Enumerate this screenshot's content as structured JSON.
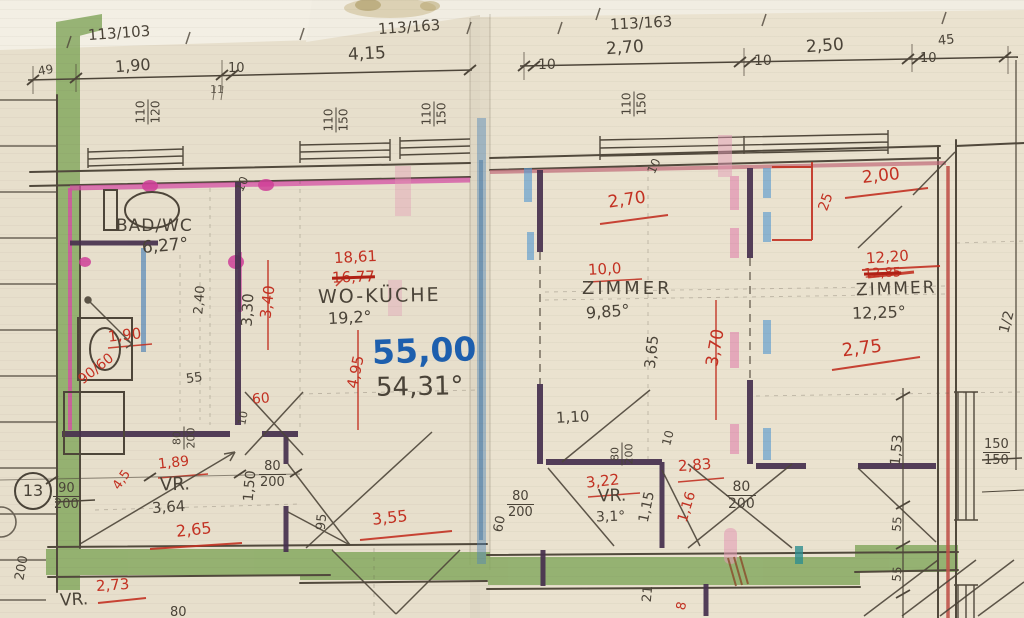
{
  "doc": {
    "type": "hand-drawn apartment floor plan"
  },
  "colors": {
    "paper": "#e7dfcc",
    "pencil": "#4a4338",
    "red_ink": "#c33122",
    "blue_ink": "#1d5fae",
    "green_marker": "#83a75d",
    "magenta_marker": "#d44fa4",
    "purple_wall": "#46304e",
    "red_wall": "#c0544a",
    "blue_marker": "#4f86b8",
    "pink_marker": "#e39ab5"
  },
  "header": {
    "parcel_left": "113/103",
    "parcel_mid": "113/163",
    "parcel_right": "113/163",
    "d_49": "49",
    "d_190": "1,90",
    "d_10a": "10",
    "d_415": "4,15",
    "d_10b": "10",
    "d_270": "2,70",
    "d_10c": "10",
    "d_250": "2,50",
    "d_10d": "10",
    "d_45": "45",
    "tick_11": "11"
  },
  "windows": {
    "w1_top": "110",
    "w1_bot": "120",
    "w2_top": "110",
    "w2_bot": "150",
    "w3_top": "110",
    "w3_bot": "150",
    "w4_top": "110",
    "w4_bot": "150"
  },
  "bad": {
    "name": "BAD/WC",
    "area": "6,27°",
    "door": "90/60",
    "w_red": "1,90",
    "h_240": "2,40",
    "h_330": "3,30",
    "h_340": "3,40",
    "wall": "10"
  },
  "wk": {
    "name": "WO-KÜCHE",
    "area": "19,2°",
    "area_red": "18,61",
    "area_old": "16,77",
    "sum_blue": "55,00",
    "sum_pencil": "54,31°",
    "h_495": "4,95"
  },
  "zm": {
    "name": "ZIMMER",
    "area": "9,85°",
    "area_red": "10,0",
    "w_270": "2,70",
    "h_365": "3,65",
    "h_370": "3,70",
    "wall": "10"
  },
  "zr": {
    "name": "ZIMMER",
    "area": "12,25°",
    "area_red": "12,20",
    "area_old": "12,85",
    "w_200": "2,00",
    "w_275": "2,75",
    "side_25": "25"
  },
  "re": {
    "half": "1/2",
    "win_top": "150",
    "win_bot": "150",
    "h_153": "1,53",
    "h_55a": "55",
    "h_55b": "55"
  },
  "vl": {
    "name": "VR.",
    "area": "3,64",
    "red_189": "1,89",
    "w_265": "2,65",
    "diag_45": "4,5",
    "h_150": "1,50",
    "d80a_top": "80",
    "d80a_bot": "200",
    "d80b_top": "80",
    "d80b_bot": "200",
    "entry_top": "90",
    "entry_bot": "200",
    "s_55": "55",
    "gap_60": "60",
    "wall": "10",
    "h_95": "95",
    "ref": "13"
  },
  "vm": {
    "name": "VR.",
    "area": "3,1°",
    "open_110": "1,10",
    "red_322": "3,22",
    "red_283": "2,83",
    "h_115": "1,15",
    "h_116": "1,16",
    "wall": "10",
    "d80a_top": "80",
    "d80a_bot": "200",
    "d80b_top": "80",
    "d80b_bot": "200",
    "d80c_top": "80",
    "d80c_bot": "200",
    "gap_60": "60",
    "w_355": "3,55"
  },
  "bt": {
    "name": "VR.",
    "red_273": "2,73",
    "d_80": "80",
    "side_200": "200",
    "h_21": "21",
    "red_8": "8"
  }
}
